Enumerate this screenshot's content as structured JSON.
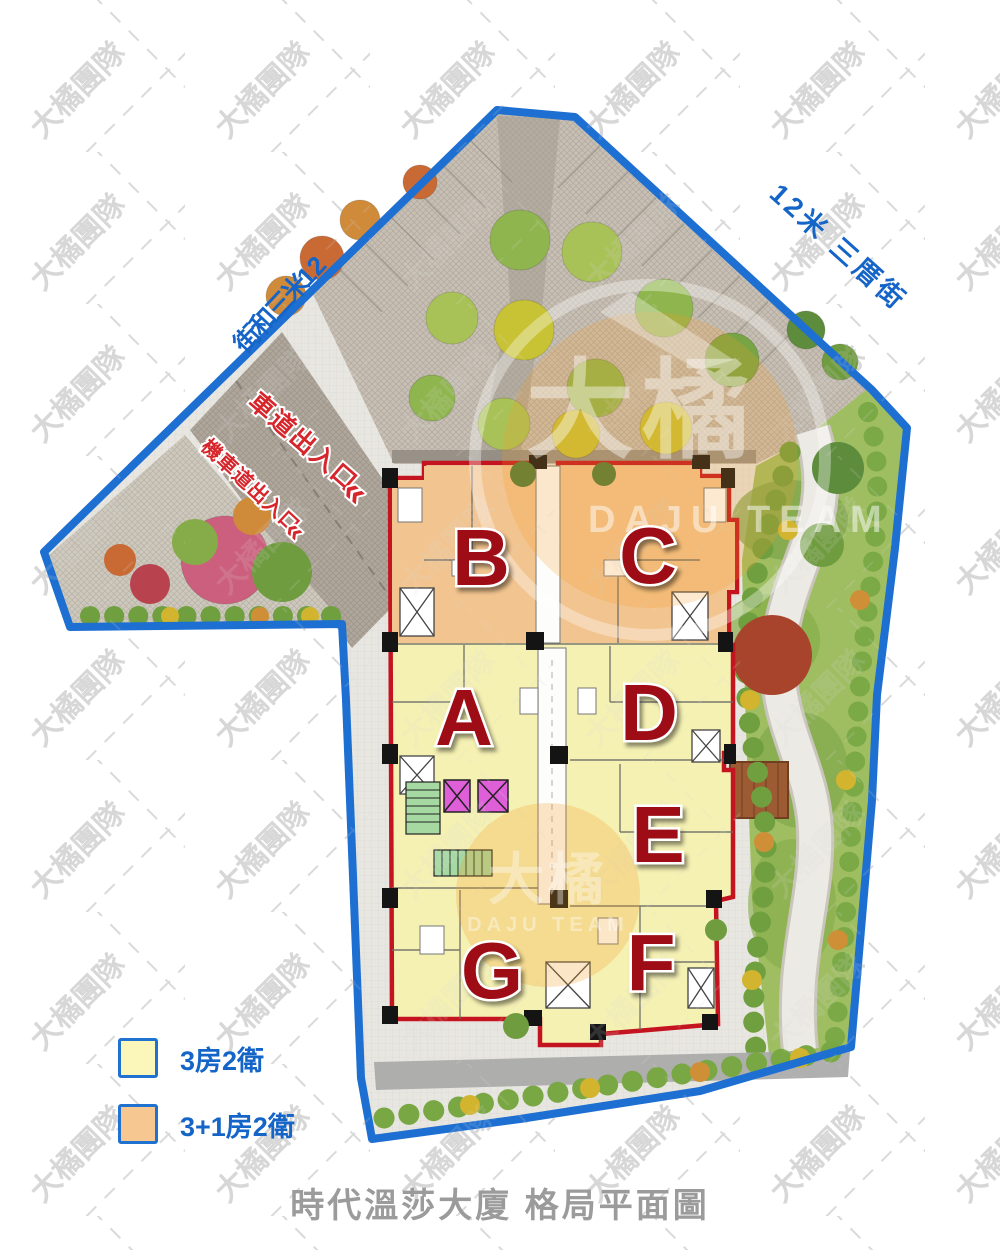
{
  "page": {
    "title": "時代溫莎大廈 格局平面圖"
  },
  "watermark": {
    "tile": "大橘團隊",
    "logo": "大橘",
    "logo_sub": "DAJU TEAM"
  },
  "streets": {
    "left": {
      "label": "12米三和街",
      "chars": [
        "12",
        "米",
        "三",
        "和",
        "街"
      ]
    },
    "right": {
      "label": "12米 三厝街"
    }
  },
  "entrances": {
    "car": {
      "label": "車道出入口",
      "arrow": "«"
    },
    "moto": {
      "label": "機車道出入口",
      "arrow": "«"
    }
  },
  "units": [
    {
      "id": "A",
      "type": "3房2衛"
    },
    {
      "id": "B",
      "type": "3+1房2衛"
    },
    {
      "id": "C",
      "type": "3+1房2衛"
    },
    {
      "id": "D",
      "type": "3房2衛"
    },
    {
      "id": "E",
      "type": "3房2衛"
    },
    {
      "id": "F",
      "type": "3房2衛"
    },
    {
      "id": "G",
      "type": "3房2衛"
    }
  ],
  "legend": [
    {
      "label": "3房2衛",
      "color": "#fbf7bb"
    },
    {
      "label": "3+1房2衛",
      "color": "#f6c790"
    }
  ],
  "colors": {
    "site_boundary": "#1d6fd1",
    "building_outline": "#c41420",
    "unit_3br_fill": "#f5f1b3",
    "unit_3p1br_fill": "#f2c48f",
    "street_label_blue": "#1565c8",
    "entrance_label_red": "#d6252b",
    "unit_letter_red": "#9e1117",
    "title_gray": "#9b9b9b"
  }
}
